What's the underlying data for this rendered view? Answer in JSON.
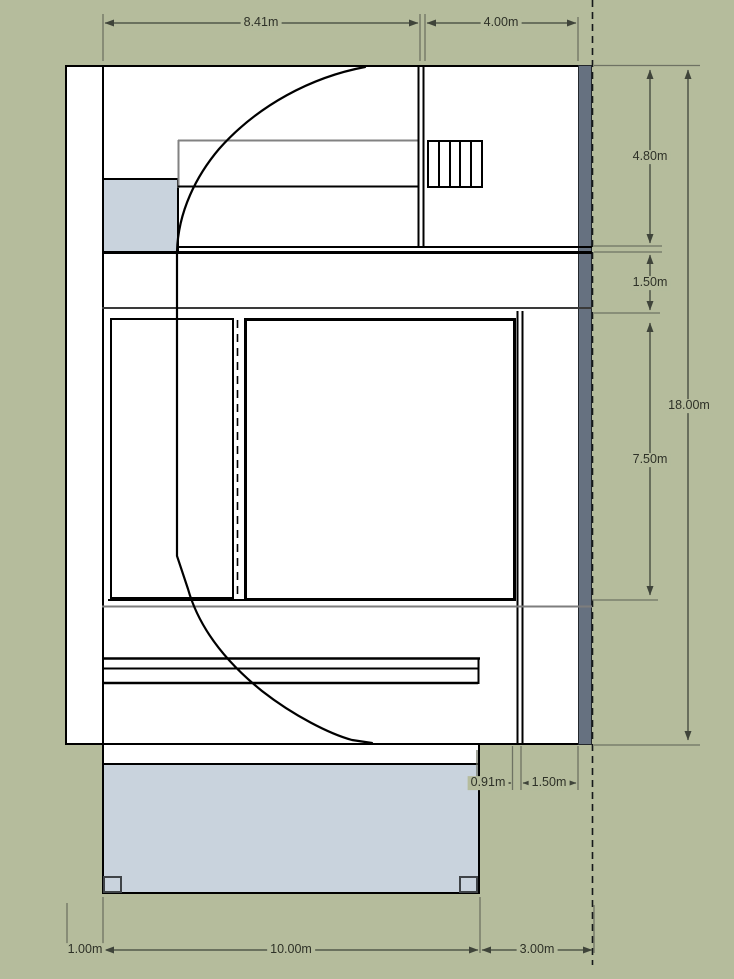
{
  "drawing": {
    "title": "floor-plan",
    "unit": "m",
    "colors": {
      "background": "#b5bc9c",
      "paper": "#ffffff",
      "accent_fill": "#c9d3dd",
      "wall_band": "#667180",
      "wall_line": "#000000",
      "dim_text": "#2e3127"
    },
    "dims": {
      "top": [
        {
          "id": "upper-width-left",
          "label": "8.41m"
        },
        {
          "id": "upper-width-right",
          "label": "4.00m"
        }
      ],
      "right": [
        {
          "id": "upper-depth",
          "label": "4.80m"
        },
        {
          "id": "corridor-depth",
          "label": "1.50m"
        },
        {
          "id": "middle-depth",
          "label": "7.50m"
        },
        {
          "id": "total-depth",
          "label": "18.00m"
        }
      ],
      "inner": [
        {
          "id": "wall-offset",
          "label": "0.91m"
        },
        {
          "id": "side-corridor-width",
          "label": "1.50m"
        }
      ],
      "bottom": [
        {
          "id": "left-offset",
          "label": "1.00m"
        },
        {
          "id": "porch-width",
          "label": "10.00m"
        },
        {
          "id": "right-offset",
          "label": "3.00m"
        }
      ]
    }
  }
}
